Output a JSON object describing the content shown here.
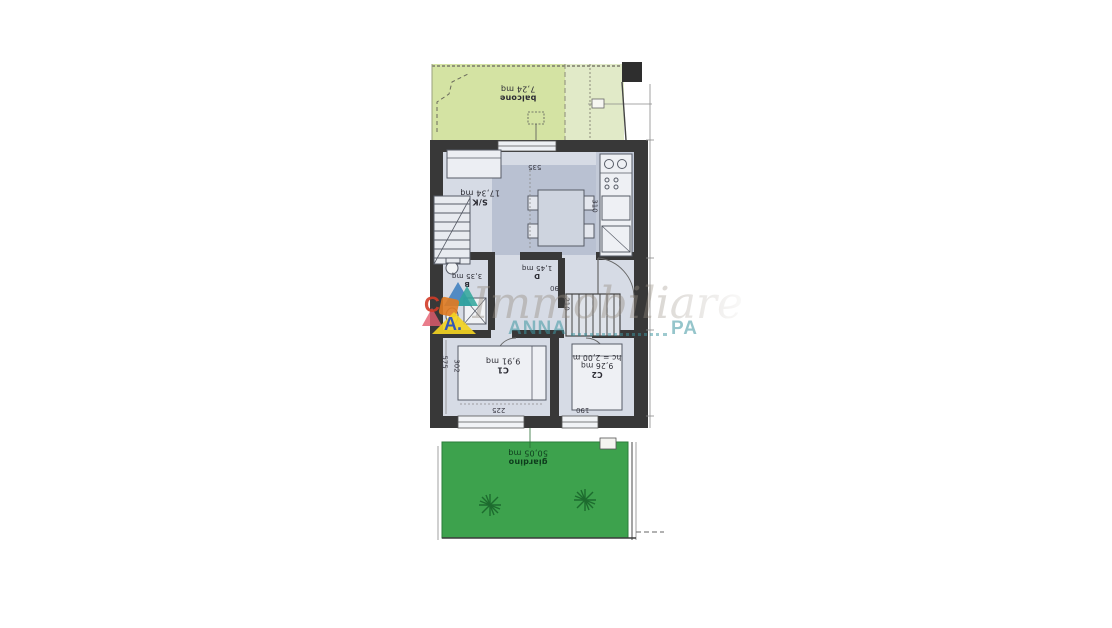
{
  "plan": {
    "rooms": {
      "balcone": {
        "name": "balcone",
        "area": "7,24 mq"
      },
      "soggiorno_cucina": {
        "name": "S/K",
        "area": "17,34 mq"
      },
      "bagno": {
        "name": "B",
        "area": "3,35 mq"
      },
      "disimpegno": {
        "name": "D",
        "area": "1,45 mq"
      },
      "camera1": {
        "name": "C1",
        "area": "9,91 mq"
      },
      "camera2": {
        "name": "C2",
        "area": "9,26 mq",
        "height_note": "hc = 2,00 m"
      },
      "giardino": {
        "name": "giardino",
        "area": "50,05 mq"
      }
    },
    "dimensions": {
      "d535": "535",
      "d310": "310",
      "d225": "225",
      "d190": "190",
      "d90": "90",
      "d210": "210",
      "d575": "575",
      "d302": "302"
    },
    "watermark": {
      "script_text": "Immobiliare",
      "caps_left": "ANNA",
      "caps_right": "PA",
      "logo_letter_1": "C",
      "logo_letter_2": "A."
    },
    "colors": {
      "wall": "#383838",
      "floor": "#d6dbe5",
      "kitchen_floor": "#b9c1d2",
      "terrace_green": "#d4e3a3",
      "terrace_green_pale": "#e1eac8",
      "garden_green": "#3da24d",
      "watermark_teal": "#3e96a0",
      "watermark_gray": "#968c80"
    }
  }
}
